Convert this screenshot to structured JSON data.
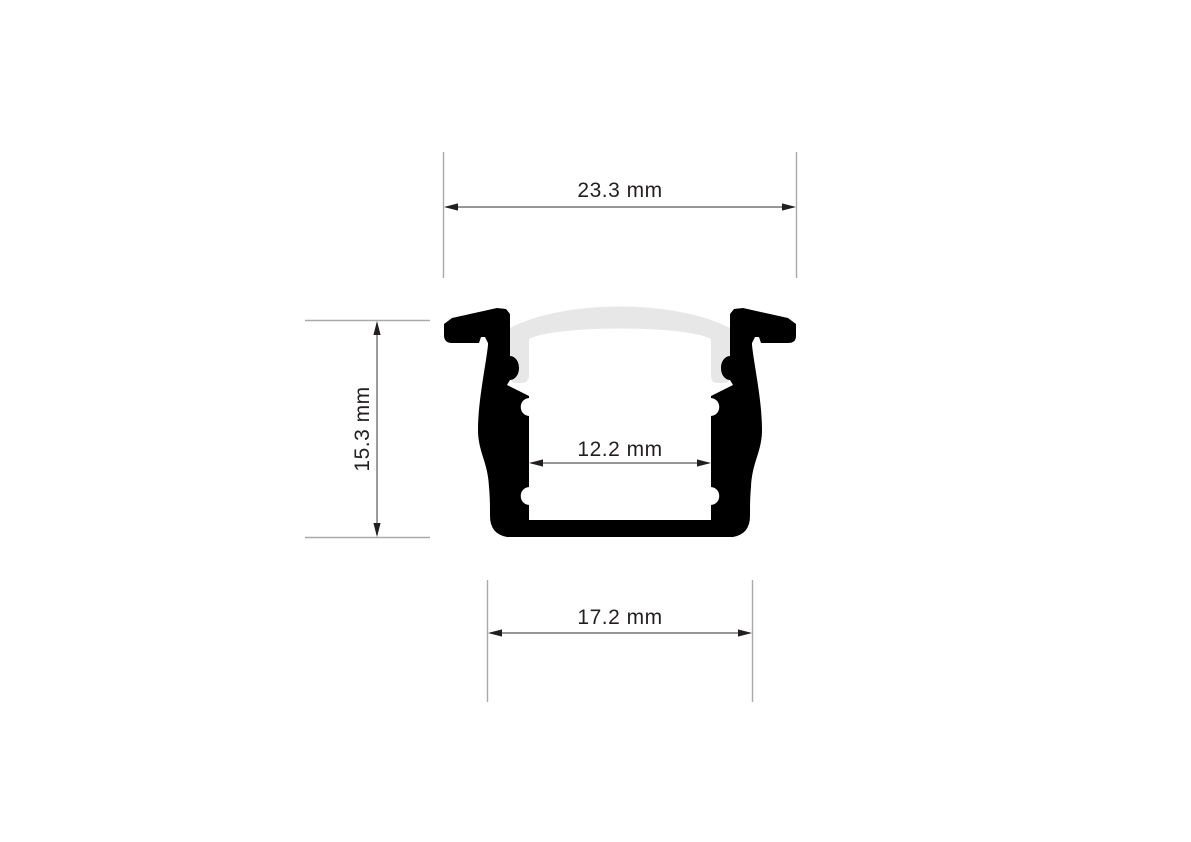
{
  "drawing": {
    "type": "led-profile-cross-section",
    "dimensions": {
      "top_width": "23.3 mm",
      "height": "15.3 mm",
      "inner_width": "12.2 mm",
      "bottom_width": "17.2 mm"
    },
    "colors": {
      "profile_body": "#000000",
      "diffuser_cover": "#e7e7e7",
      "dimension_line": "#58595b",
      "extension_line": "#a7a9ac",
      "label_text": "#231f20"
    },
    "background": "#ffffff"
  }
}
